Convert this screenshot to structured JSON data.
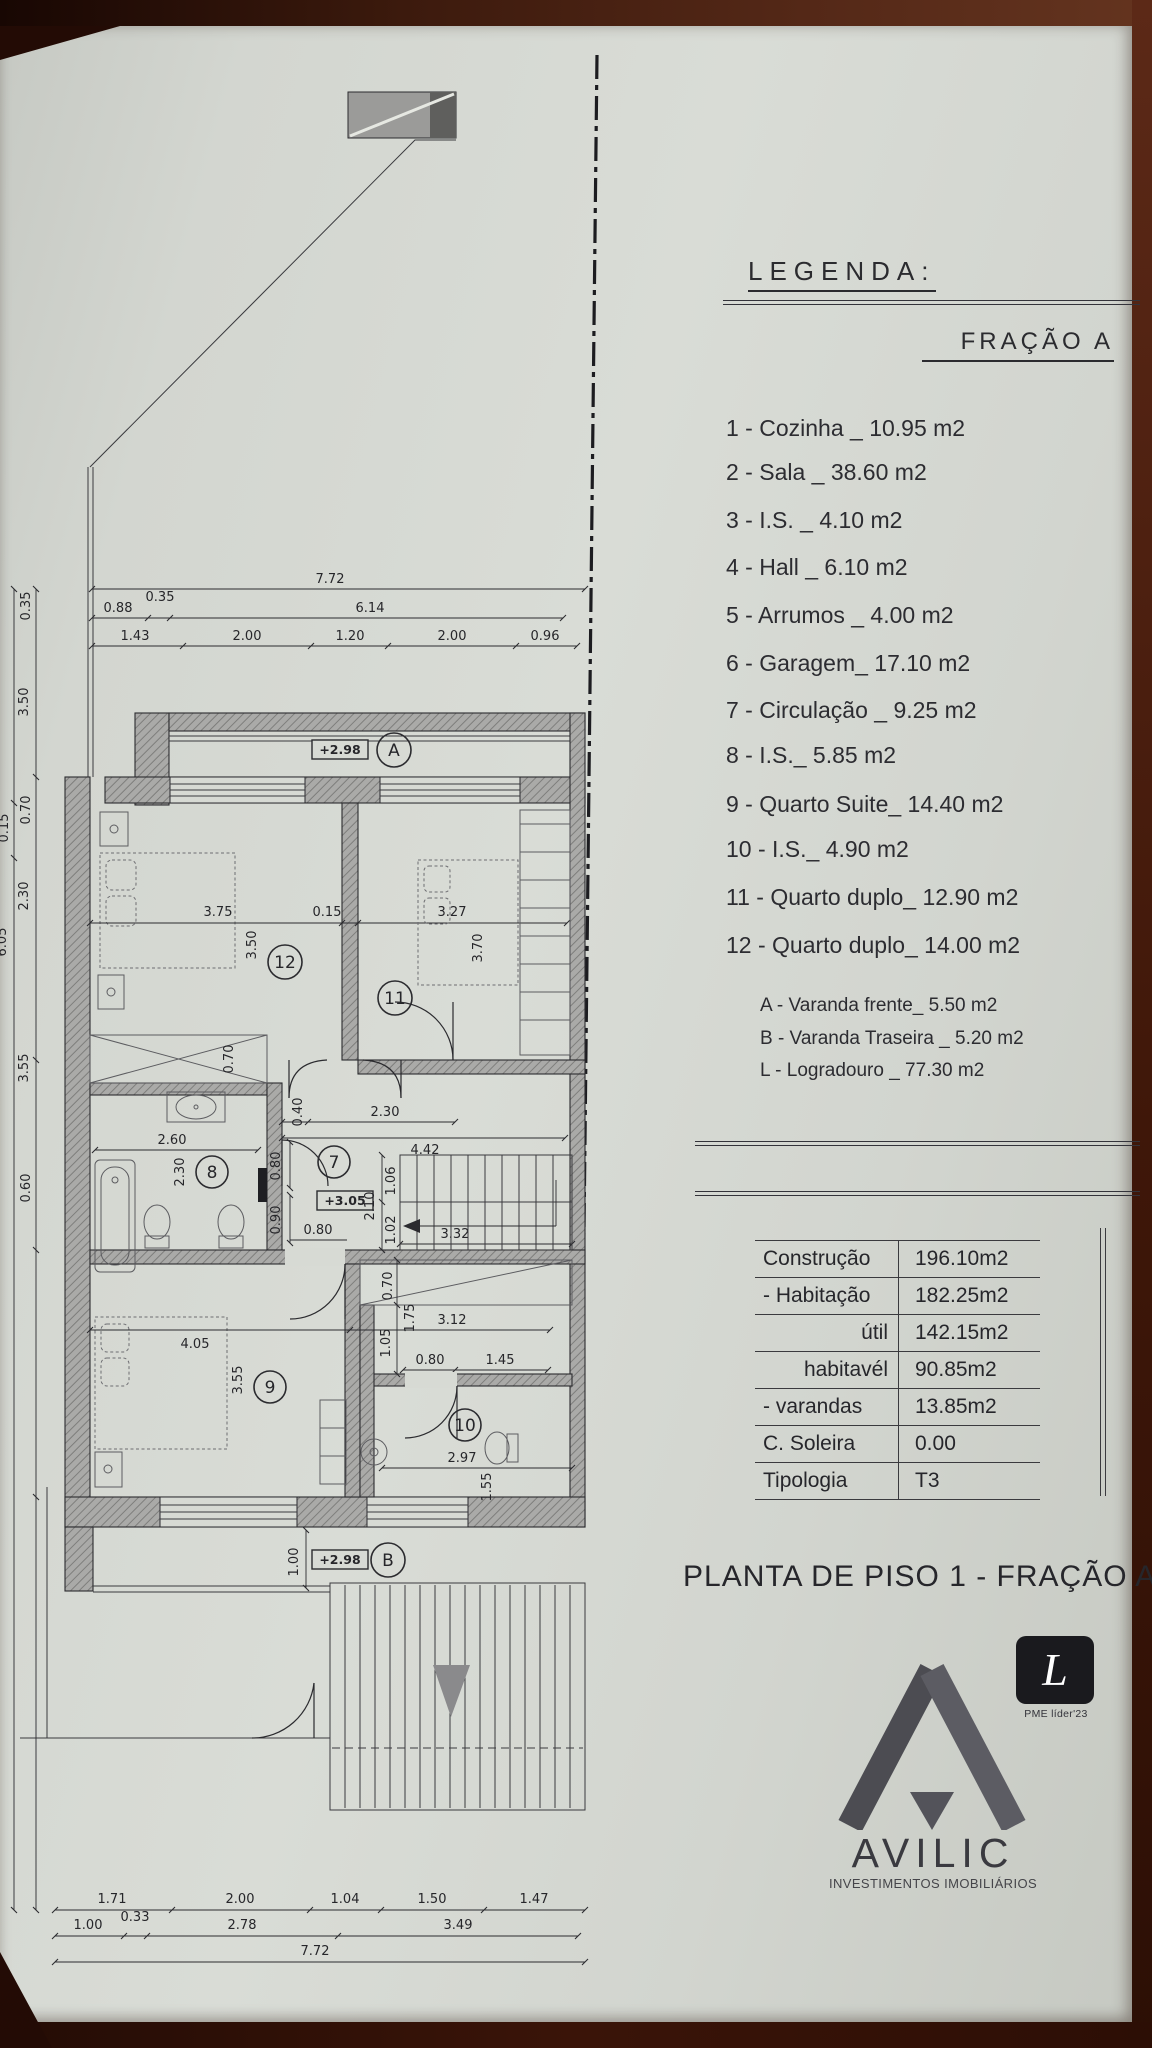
{
  "legend": {
    "title": "LEGENDA:",
    "fraction": "FRAÇÃO A",
    "items": [
      "1 - Cozinha _ 10.95 m2",
      "2 - Sala _ 38.60 m2",
      "3 - I.S. _ 4.10 m2",
      "4 - Hall _ 6.10 m2",
      "5 - Arrumos _ 4.00 m2",
      "6 - Garagem_ 17.10 m2",
      "7 - Circulação _ 9.25 m2",
      "8 - I.S._ 5.85 m2",
      "9 - Quarto Suite_ 14.40 m2",
      "10 - I.S._ 4.90 m2",
      "11 - Quarto duplo_ 12.90 m2",
      "12 - Quarto duplo_ 14.00 m2"
    ],
    "sub_items": [
      "A - Varanda frente_ 5.50 m2",
      "B - Varanda Traseira _ 5.20 m2",
      "L - Logradouro _ 77.30 m2"
    ]
  },
  "areas_table": {
    "rows": [
      {
        "label": "Construção",
        "value": "196.10m2"
      },
      {
        "label": "- Habitação",
        "value": "182.25m2"
      },
      {
        "label": "útil",
        "value": "142.15m2"
      },
      {
        "label": "habitavél",
        "value": "90.85m2"
      },
      {
        "label": "- varandas",
        "value": "13.85m2"
      },
      {
        "label": "C. Soleira",
        "value": "0.00"
      },
      {
        "label": "Tipologia",
        "value": "T3"
      }
    ]
  },
  "sheet_title": "PLANTA DE PISO 1 - FRAÇÃO A",
  "logo": {
    "brand": "AVILIC",
    "tagline": "INVESTIMENTOS IMOBILIÁRIOS",
    "badge_letter": "L",
    "badge_label": "PME líder'23"
  },
  "plan": {
    "room_labels": {
      "a": "A",
      "r12": "12",
      "r11": "11",
      "r7": "7",
      "r8": "8",
      "r9": "9",
      "r10": "10",
      "b": "B"
    },
    "levels": {
      "a": "+2.98",
      "circ": "+3.05",
      "b": "+2.98"
    },
    "dims": {
      "top_total": "7.72",
      "top2": [
        "0.88",
        "0.35",
        "6.14"
      ],
      "top3": [
        "1.43",
        "2.00",
        "1.20",
        "2.00",
        "0.96"
      ],
      "left_inner": [
        "0.35",
        "3.50",
        "0.70",
        "2.30",
        "3.55",
        "0.60"
      ],
      "left_outer": [
        "0.15",
        "6.05"
      ],
      "r12_w": "3.75",
      "r12_gap": "0.15",
      "r12_h": "3.50",
      "r11_w": "3.27",
      "r11_h": "3.70",
      "wardrobe": "0.70",
      "hall_a": "0.40",
      "hall_b": "2.30",
      "hall_c": "4.42",
      "hall_d": "0.80",
      "hall_e": "0.90",
      "hall_f": "0.80",
      "hall_g": "3.32",
      "stair_total": "2.10",
      "stair_a": "1.06",
      "stair_b": "1.02",
      "bath_w": "2.60",
      "bath_h": "2.30",
      "r9_w": "4.05",
      "r9_h": "3.55",
      "zone_a": "0.70",
      "zone_b": "3.12",
      "zone_c": "1.75",
      "zone_d": "1.05",
      "zone_e": "0.80",
      "zone_f": "1.45",
      "r10_w": "2.97",
      "r10_h": "1.55",
      "balcony_b": "1.00",
      "bottom1": [
        "1.71",
        "2.00",
        "1.04",
        "1.50",
        "1.47"
      ],
      "bottom2": [
        "1.00",
        "0.33",
        "2.78",
        "3.49"
      ],
      "bottom_total": "7.72"
    }
  }
}
